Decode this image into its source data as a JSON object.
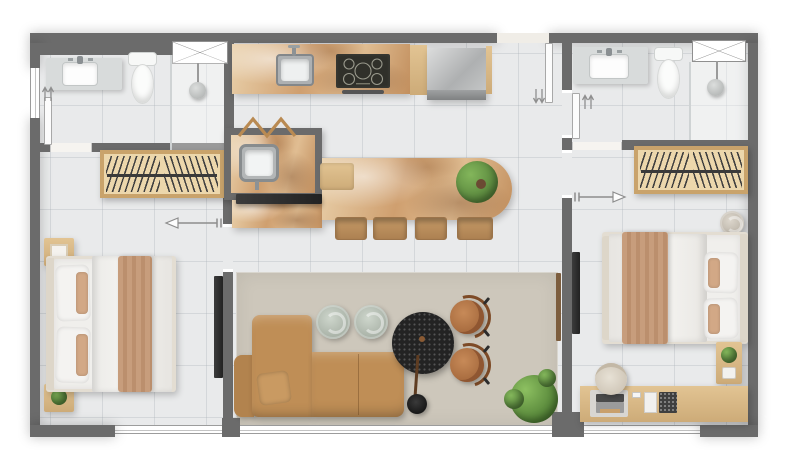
{
  "canvas": {
    "width": 785,
    "height": 468,
    "background": "#ffffff"
  },
  "palette": {
    "wall": "#6b6b6b",
    "floor": "#e9eaeb",
    "rug": "#cdc7bb",
    "wood_frame": "#c9a36b",
    "sofa": "#bf8e56",
    "sofa_dark": "#b2834e",
    "leather": "#b5774a",
    "throw": "#c49a79",
    "linen": "#f0efec",
    "cream": "#e3ddd2",
    "tv": "#2e2e2e",
    "black_table": "#232323",
    "plant": "#5f9147",
    "pouf": "#b8c1b6",
    "stone_light": "#e9d0aa",
    "stone_dark": "#c28f5e",
    "steel": "#b5b7b8"
  },
  "floor_plan": {
    "title": "Two-bedroom apartment floor plan, top-down furnished render, no text labels",
    "rooms": [
      {
        "name": "bathroom-left",
        "position": "top-left",
        "fixtures": [
          "vanity with sink",
          "toilet",
          "walk-in shower",
          "shower head",
          "crossed frosted window",
          "side wall window"
        ]
      },
      {
        "name": "bedroom-left",
        "position": "bottom-left",
        "fixtures": [
          "wardrobe with hangers",
          "double bed with tan throw",
          "nightstand with framed decor",
          "nightstand with plant",
          "wall tv panel",
          "bottom window"
        ]
      },
      {
        "name": "kitchen",
        "position": "top-center",
        "fixtures": [
          "stone countertop",
          "steel sink with faucet",
          "five-burner cooktop",
          "oven handle",
          "stainless refrigerator",
          "wood side panels"
        ]
      },
      {
        "name": "laundry-nook",
        "position": "center-left",
        "fixtures": [
          "stone counter",
          "deep utility sink",
          "wooden zigzag drying rack"
        ]
      },
      {
        "name": "kitchen-island",
        "position": "center",
        "fixtures": [
          "stone island slab with rounded end",
          "wood cutting board",
          "potted plant",
          "four wooden stools",
          "black tv panel on island end"
        ]
      },
      {
        "name": "living-room",
        "position": "bottom-center",
        "fixtures": [
          "beige area rug",
          "l-shaped tan sofa with pillow",
          "two round ceramic poufs",
          "black terrazzo round coffee table",
          "arc floor lamp",
          "two cognac leather armchairs",
          "large floor plant",
          "panoramic bottom window"
        ]
      },
      {
        "name": "hallway",
        "position": "center-right",
        "fixtures": [
          "entry door with swing handle arrows",
          "wood slat wall detail"
        ]
      },
      {
        "name": "bathroom-right",
        "position": "top-right",
        "fixtures": [
          "vanity with sink",
          "toilet",
          "walk-in shower",
          "shower head",
          "crossed frosted window"
        ]
      },
      {
        "name": "bedroom-right",
        "position": "bottom-right",
        "fixtures": [
          "wardrobe with hangers",
          "double bed with tan throw",
          "round pouf",
          "nightstand with plant",
          "desk with mat laptop phone and boxes",
          "round desk chair",
          "wall tv panel",
          "bottom window"
        ]
      }
    ],
    "doors": [
      {
        "name": "entry-door",
        "location": "top wall center-right, leaf open inward with paired handle arrows"
      },
      {
        "name": "bathroom-left-door",
        "location": "left bathroom south wall, leaf open against west wall"
      },
      {
        "name": "bedroom-left-door",
        "location": "living-room side wall, outline swing arrow pointing left"
      },
      {
        "name": "bathroom-right-door",
        "location": "hallway east wall, leaf with paired handle arrows"
      },
      {
        "name": "bedroom-right-door",
        "location": "hallway east wall, outline swing arrow pointing right"
      }
    ],
    "windows": [
      "left exterior wall (bathroom-left)",
      "crossed shower window bathroom-left",
      "crossed shower window bathroom-right",
      "bottom wall bedroom-left",
      "bottom wall living-room",
      "bottom wall bedroom-right"
    ]
  }
}
